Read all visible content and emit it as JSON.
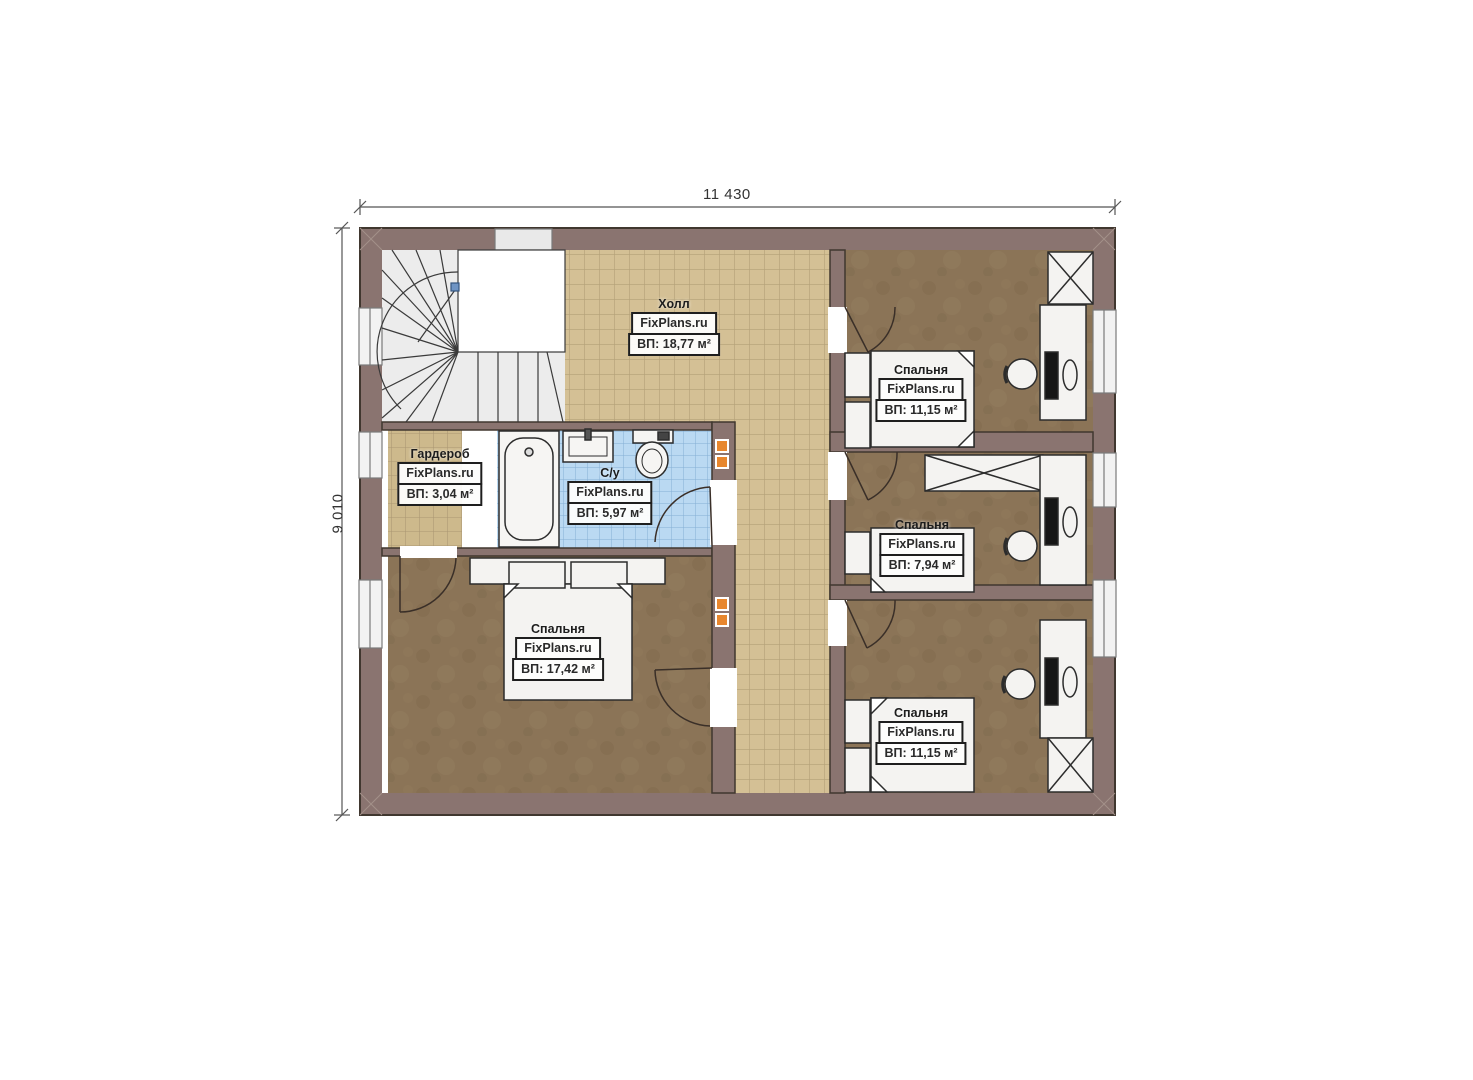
{
  "dimensions": {
    "top": "11 430",
    "left": "9 010"
  },
  "watermark": "FixPlans.ru",
  "rooms": {
    "hall": {
      "name": "Холл",
      "area": "ВП: 18,77 м²"
    },
    "wardrobe": {
      "name": "Гардероб",
      "area": "ВП: 3,04 м²"
    },
    "bathroom": {
      "name": "С/у",
      "area": "ВП: 5,97 м²"
    },
    "bedroom_master": {
      "name": "Спальня",
      "area": "ВП: 17,42 м²"
    },
    "bedroom_top_right": {
      "name": "Спальня",
      "area": "ВП: 11,15 м²"
    },
    "bedroom_mid_right": {
      "name": "Спальня",
      "area": "ВП: 7,94 м²"
    },
    "bedroom_bottom_right": {
      "name": "Спальня",
      "area": "ВП: 11,15 м²"
    }
  },
  "colors": {
    "wall": "#8a7470",
    "wall_outline": "#40372f",
    "hall_tile": "#d4c095",
    "hall_tile_grid": "#b3a077",
    "wardrobe_tile": "#cdb98c",
    "bathroom_tile": "#bad9f2",
    "bathroom_tile_grid": "#84aed4",
    "bedroom_floor": "#8b7457",
    "stair_fill": "#ececec",
    "furniture": "#f4f3f1",
    "window_fill": "#f2f2f2",
    "accent_orange": "#e8872e"
  }
}
